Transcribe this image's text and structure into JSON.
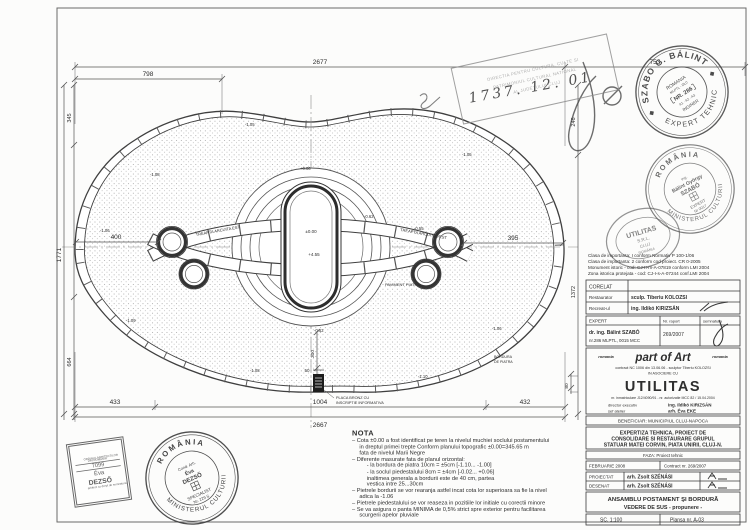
{
  "sheet": {
    "frame_color": "#5a5a5a",
    "bg": "#fcfcfb"
  },
  "drawing": {
    "dims": {
      "top_overall": "2677",
      "top_left": "798",
      "top_right": "753",
      "bottom_overall": "2667",
      "bottom_left": "433",
      "bottom_center": "1004",
      "bottom_right": "432",
      "left_overall": "1771",
      "left_top": "345",
      "left_bottom": "664",
      "right_top": "246",
      "right_bottom": "1372",
      "inner_left": "400",
      "inner_right": "395",
      "plaque_height": "300",
      "plaque_width": "50",
      "edge_small": "80"
    },
    "levels": [
      "-1.05",
      "-1.06",
      "-1.08",
      "-1.09",
      "-1.10",
      "-0.62",
      "-0.55",
      "+0.06"
    ],
    "center": {
      "top_label": "±0.00",
      "mid_label": "+4.55"
    },
    "labels": {
      "band_left": "TREAPTA ARCUITA EST",
      "band_right": "TREAPTA ARCUITA VEST",
      "paving": "PAVIMENT PIATRA",
      "plaque_line1": "PLACA BRONZ CU",
      "plaque_line2": "INSCRIPTIE INFORMATIVA",
      "curb_line1": "BORDURA",
      "curb_line2": "DE PIATRA"
    },
    "handwritten_date": "1737. 12. 01"
  },
  "stamps": {
    "approval_box": {
      "line1": "DIRECTIA PENTRU CULTURA, CULTE SI",
      "line2": "PATRIMONIUL CULTURAL NATIONAL",
      "line3": "AL JUDETULUI CLUJ"
    },
    "szabo": {
      "ring_top": "SZABO G. BÁLINT",
      "ring_bottom": "EXPERT TEHNIC",
      "inner1": "ROMANIA",
      "inner2": "MLPTL - DLC",
      "nr": "NR. 286",
      "inner3": "A1 · A2 · A3",
      "inner4": "INGINER"
    },
    "balint": {
      "ring_top": "R O M Â N I A",
      "ring_bottom": "MINISTERUL CULTURII",
      "line1": "ing.",
      "line2": "Bálint György",
      "line3": "SZABÓ",
      "line4": "EXPERT",
      "line5": "Nr 0017"
    },
    "utilitas": {
      "line1": "UTILITAS",
      "line2": "S.R.L.",
      "line3": "CLUJ",
      "line4": "ROMÂNIA"
    },
    "oar": {
      "line1": "ORDINUL ARHITECTILOR",
      "line2": "DIN ROMÂNIA",
      "line3": "7099",
      "line4": "Éva",
      "line5": "DEZSŐ",
      "line6": "arhitect cu drept de semnatura"
    },
    "dezso": {
      "ring_top": "R O M Â N I A",
      "ring_bottom": "MINISTERUL CULTURII",
      "line1": "Cond. Arh.",
      "line2": "Éva",
      "line3": "DEZSŐ",
      "line4": "SPECIALIST",
      "line5": "Nr. 229 S"
    }
  },
  "nota": {
    "title": "NOTA",
    "lines": [
      {
        "t": "– Cota ±0.00 a fost identificat pe teren  la nivelul muchiei soclului  postamentului",
        "ind": 0
      },
      {
        "t": "in dreptul primei trepte Conform planului  topografic  ±0.00=345.65 m",
        "ind": 1
      },
      {
        "t": "fata de nivelul Marii Negre",
        "ind": 1
      },
      {
        "t": "– Diferente masurate fata de planul orizontal:",
        "ind": 0
      },
      {
        "t": "-  la bordura de piatra 10cm = ±5cm  [-1.10... -1.00]",
        "ind": 2
      },
      {
        "t": "-  la soclul piedestalului 8cm = ±4cm  [-0.02... +0.06]",
        "ind": 2
      },
      {
        "t": "inaltimea generala a bordurii este de 40 cm, partea",
        "ind": 2
      },
      {
        "t": "vestica intre 25...30cm",
        "ind": 2
      },
      {
        "t": "– Pietrele bordurii se vor rearanja astfel incat cota lor superioara sa fie la nivel",
        "ind": 0
      },
      {
        "t": "adica la -1.06",
        "ind": 1
      },
      {
        "t": "– Pietrele piedestalului se vor reaseza in pozitiile lor initiale cu corectii minore",
        "ind": 0
      },
      {
        "t": "– Se va asigura o panta MINIMA de 0,5% strict spre exterior  pentru facilitarea",
        "ind": 0
      },
      {
        "t": "scurgerii apelor pluviale",
        "ind": 1
      }
    ]
  },
  "titleblock": {
    "classes": [
      "Clasa de importanta:   I conform Normativ P 100-1/06",
      "Clasa de importanta:   2 conform cod proiect. CR 0-2005",
      "Monument istoric - cod: CJ-II-m-A-07819 conform LMI 2004",
      "Zona istorica protejata - cod: CJ-I-s-A-07244 conf.LMI 2004"
    ],
    "corelat": {
      "header": "CORELAT",
      "rows": [
        {
          "role": "Restaurator",
          "name": "sculp. Tiberiu KOLOZSI"
        },
        {
          "role": "Recreat-ul",
          "name": "ing. Ildikó KIRIZSÁN"
        }
      ]
    },
    "expert": {
      "header": "EXPERT",
      "col_raport": "Nr. raport",
      "col_sign": "semnatura",
      "name": "dr. ing. Bálint SZABÓ",
      "name2": "nr.286 MLPTL,  0015 MCC",
      "raport": "269/2007"
    },
    "partofart": {
      "left": "romania",
      "logo": "part of Art",
      "right": "romania",
      "contract": "contract NC 1006 din 13.06.06  -  sculptor Tiberiu KOLOZSI",
      "asociere": "IN ASOCIERE CU"
    },
    "utilitas": {
      "logo": "UTILITAS",
      "reg": "nr. inmatriculare  J12/4090/91   -   nr. autorizatie MCC  82 / 15.04.2004",
      "dir_label": "director executiv",
      "dir_name": "ing. Ildikó KIRIZSÁN",
      "sef_label": "sef atelier",
      "sef_name": "arh. Éva EKE"
    },
    "beneficiar": "BENEFICIAR: MUNICIPIUL CLUJ-NAPOCA",
    "title_lines": [
      "EXPERTIZA TEHNICA, PROIECT DE",
      "CONSOLIDARE SI RESTAURARE GRUPUL",
      "STATUAR MATEI CORVIN, PIATA UNIRII, CLUJ-N."
    ],
    "faza": "FAZA: Proiect tehnic",
    "date": "FEBRUARIE 2008",
    "contract": "Contract nr. 269/2007",
    "proiectat_label": "PROIECTAT",
    "proiectat_name": "arh. Zsolt SZÉNÁSI",
    "desenat_label": "DESENAT",
    "desenat_name": "arh. Zsolt SZÉNÁSI",
    "plansa_line1": "ANSAMBLU POSTAMENT ŞI BORDURĂ",
    "plansa_line2": "VEDERE DE SUS  - propunere -",
    "scale": "SC. 1:100",
    "plansa_nr": "Plansa nr.  A-03"
  }
}
